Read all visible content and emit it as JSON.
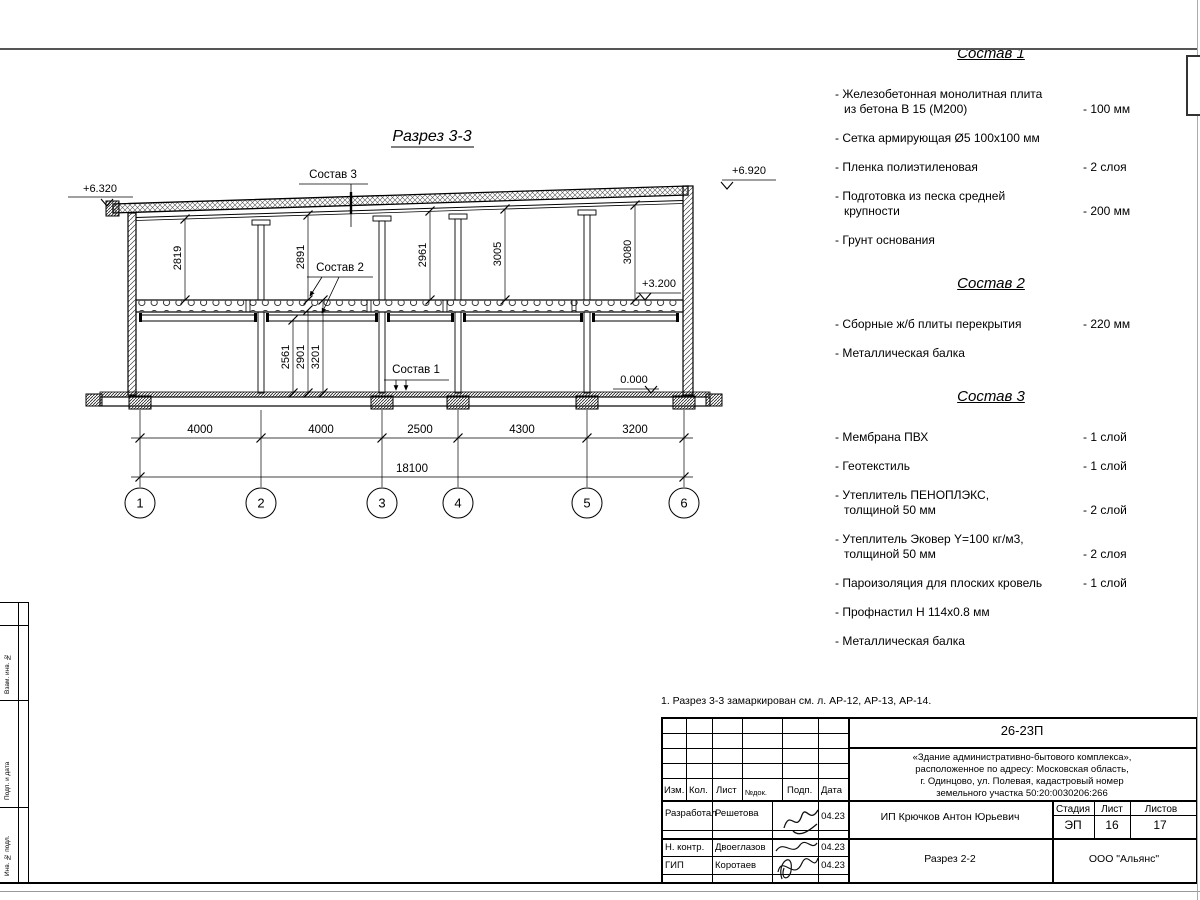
{
  "drawing": {
    "title": "Разрез 3-3",
    "elev_left": "+6.320",
    "elev_right": "+6.920",
    "elev_mid": "+3.200",
    "elev_zero": "0.000",
    "callout3": "Состав 3",
    "callout2": "Состав 2",
    "callout1": "Состав 1",
    "upper_dims": [
      "2819",
      "2891",
      "2961",
      "3005",
      "3080"
    ],
    "lower_dims": [
      "2561",
      "2901",
      "3201"
    ],
    "span_dims": [
      "4000",
      "4000",
      "2500",
      "4300",
      "3200"
    ],
    "total_dim": "18100",
    "axes": [
      "1",
      "2",
      "3",
      "4",
      "5",
      "6"
    ]
  },
  "comp1": {
    "title": "Состав 1",
    "items": [
      {
        "l1": "- Железобетонная  монолитная плита",
        "l2": "из бетона В 15 (М200)",
        "val": "- 100 мм"
      },
      {
        "l1": "- Сетка армирующая Ø5 100х100 мм"
      },
      {
        "l1": "- Пленка полиэтиленовая",
        "val": "-  2 слоя"
      },
      {
        "l1": "- Подготовка из песка средней",
        "l2": "крупности",
        "val": "- 200 мм"
      },
      {
        "l1": "- Грунт основания"
      }
    ]
  },
  "comp2": {
    "title": "Состав 2",
    "items": [
      {
        "l1": "- Сборные ж/б плиты перекрытия",
        "val": "- 220 мм"
      },
      {
        "l1": "- Металлическая балка"
      }
    ]
  },
  "comp3": {
    "title": "Состав 3",
    "items": [
      {
        "l1": "- Мембрана ПВХ",
        "val": "- 1 слой"
      },
      {
        "l1": "- Геотекстиль",
        "val": "- 1 слой"
      },
      {
        "l1": "- Утеплитель ПЕНОПЛЭКС,",
        "l2": "толщиной 50 мм",
        "val": "- 2 слой"
      },
      {
        "l1": "- Утеплитель Эковер Y=100 кг/м3,",
        "l2": "толщиной 50 мм",
        "val": "- 2 слоя"
      },
      {
        "l1": "- Пароизоляция для плоских кровель",
        "val": "- 1 слой"
      },
      {
        "l1": "- Профнастил Н 114х0.8 мм"
      },
      {
        "l1": "- Металлическая балка"
      }
    ]
  },
  "note": "1. Разрез 3-3 замаркирован см. л. АР-12, АР-13, АР-14.",
  "titleblock": {
    "code": "26-23П",
    "project_line1": "«Здание административно-бытового комплекса»,",
    "project_line2": "расположенное по адресу: Московская область,",
    "project_line3": "г. Одинцово, ул. Полевая, кадастровый номер",
    "project_line4": "земельного участка 50:20:0030206:266",
    "col_izm": "Изм.",
    "col_kol": "Кол.",
    "col_list": "Лист",
    "col_ndok": "№док.",
    "col_podp": "Подп.",
    "col_data": "Дата",
    "row1_role": "Разработал",
    "row1_name": "Решетова",
    "row1_date": "04.23",
    "row2_role": "Н. контр.",
    "row2_name": "Двоеглазов",
    "row2_date": "04.23",
    "row3_role": "ГИП",
    "row3_name": "Коротаев",
    "row3_date": "04.23",
    "client": "ИП Крючков Антон Юрьевич",
    "stage_label": "Стадия",
    "sheet_label": "Лист",
    "sheets_label": "Листов",
    "stage": "ЭП",
    "sheet": "16",
    "sheets": "17",
    "drawing_name": "Разрез 2-2",
    "company": "ООО \"Альянс\""
  },
  "side_stamp": {
    "cell1": "Взам. инв. №",
    "cell2": "Подп. и дата",
    "cell3": "Инв. № подл."
  }
}
